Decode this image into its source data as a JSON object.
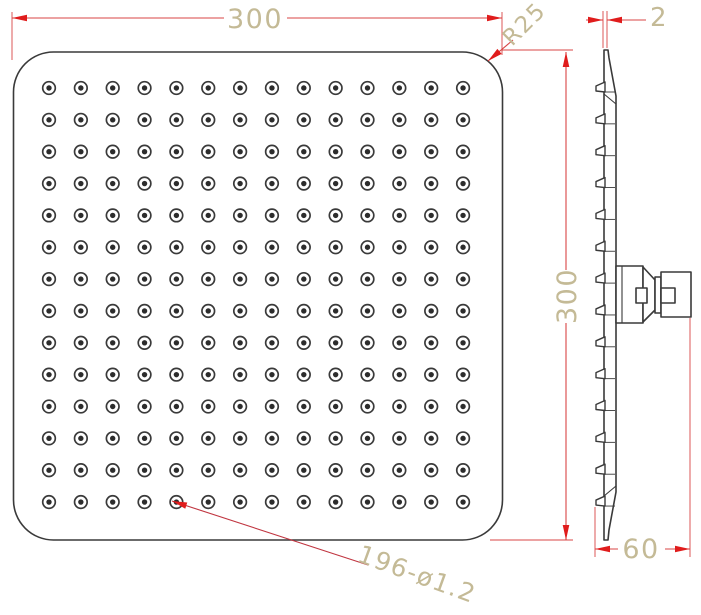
{
  "drawing": {
    "type": "technical-drawing",
    "subject": "square-rain-shower-head",
    "dims": {
      "width": "300",
      "height": "300",
      "corner_radius": "R25",
      "thickness": "2",
      "depth": "60",
      "nozzle_spec": "196-ø1.2"
    },
    "nozzle_grid": {
      "rows": 14,
      "cols": 14,
      "count": 196
    },
    "colors": {
      "background": "#ffffff",
      "outline": "#3a3a3a",
      "dim_line": "#d84545",
      "leader": "#c03540",
      "arrow": "#e01c1c",
      "dim_text": "#c4ba96"
    }
  }
}
